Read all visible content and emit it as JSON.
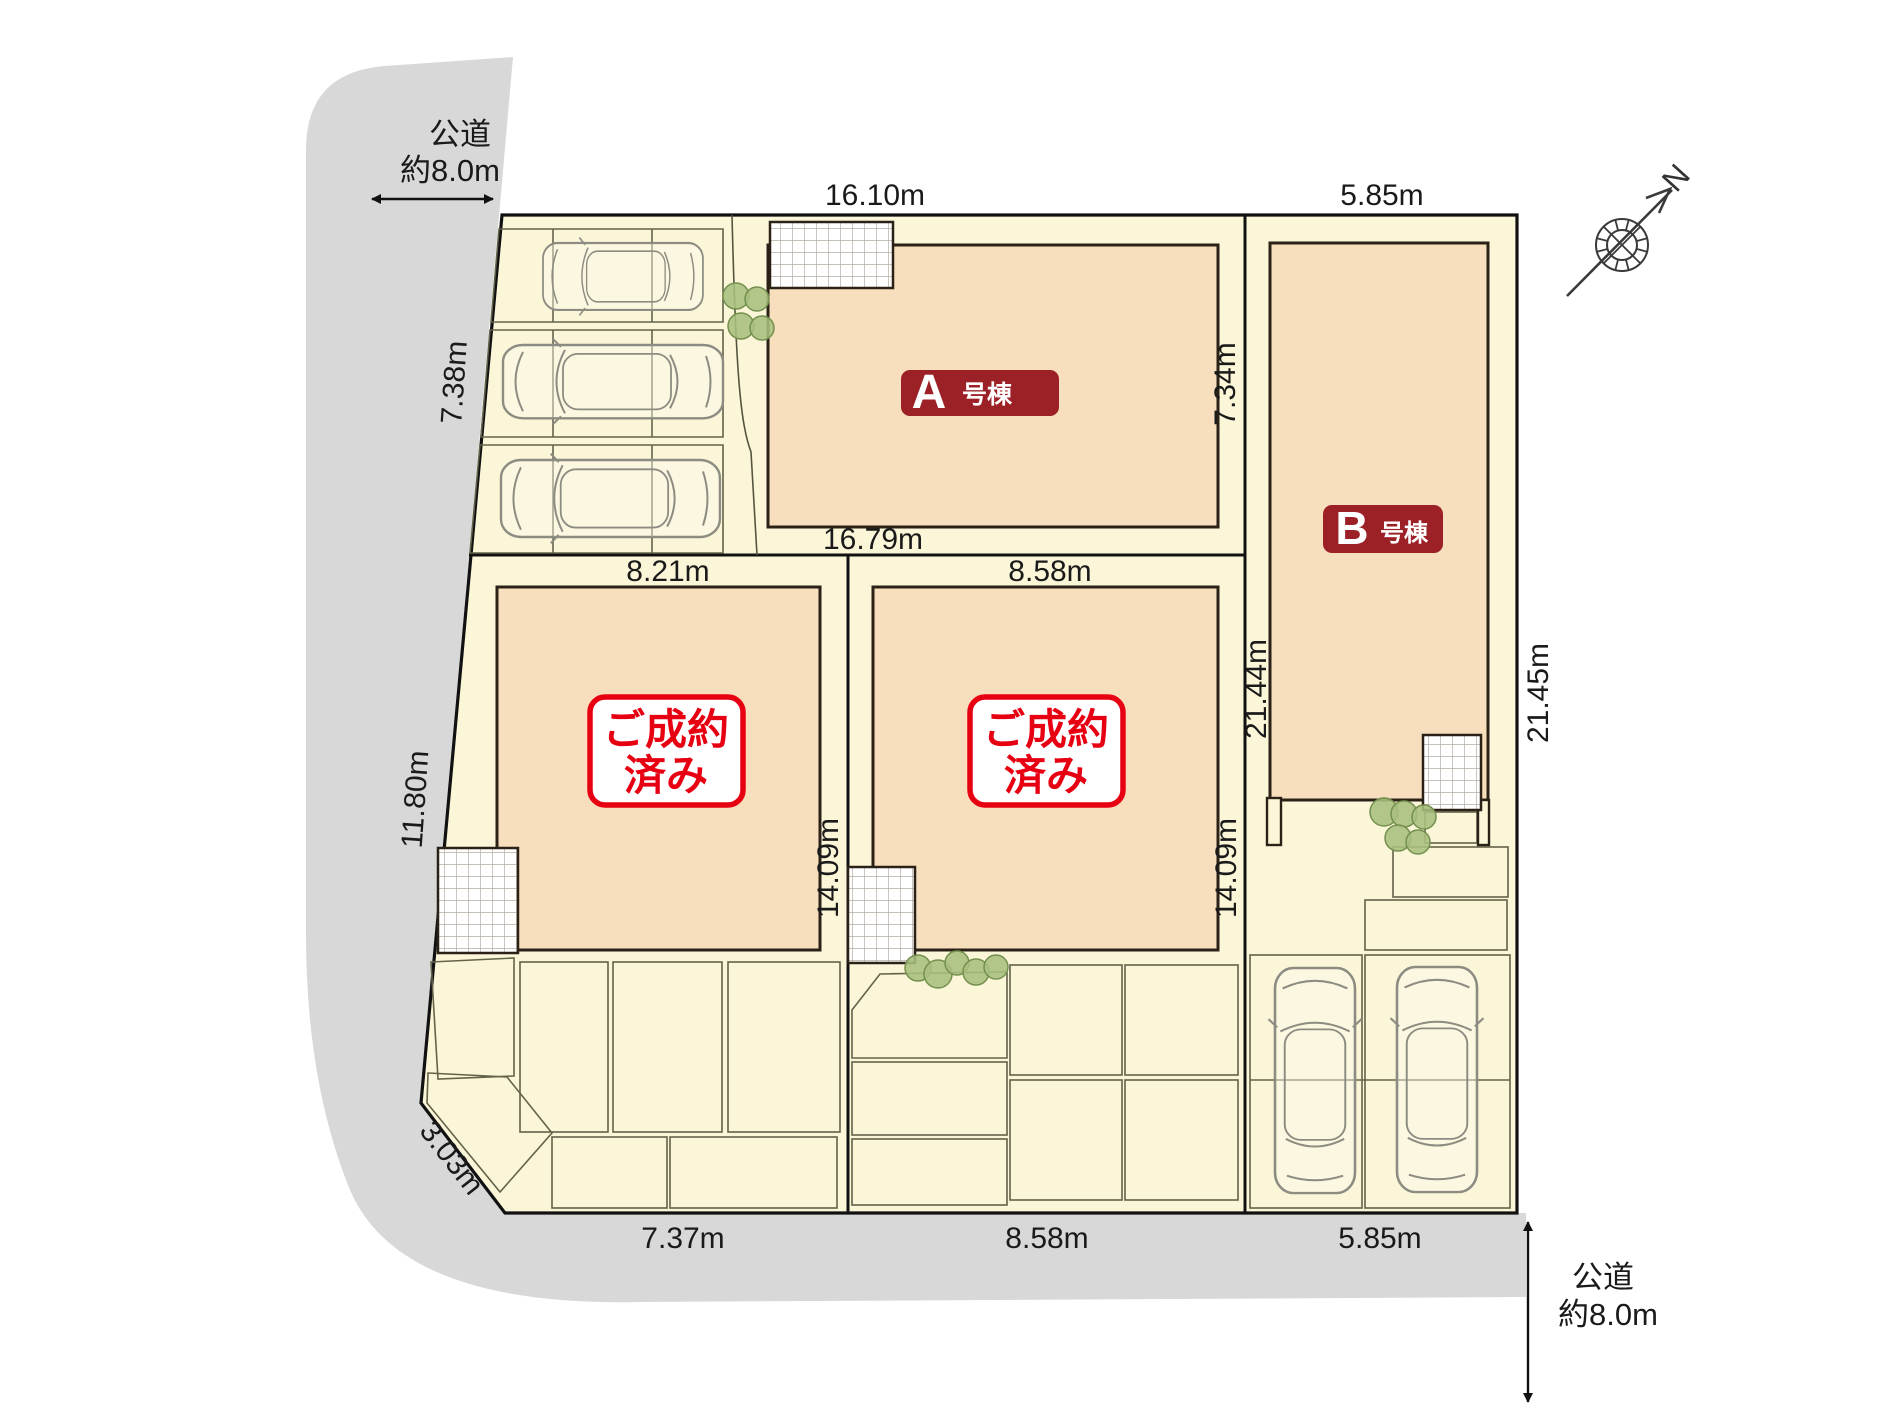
{
  "title": "分譲地 区画図 (site plan)",
  "compass": {
    "label": "N"
  },
  "roads": {
    "top_left": {
      "name_line1": "公道",
      "name_line2": "約8.0m"
    },
    "bottom_right": {
      "name_line1": "公道",
      "name_line2": "約8.0m"
    }
  },
  "units": {
    "a": {
      "label": "A",
      "suffix": "号棟"
    },
    "b": {
      "label": "B",
      "suffix": "号棟"
    },
    "sold_left": {
      "line1": "ご成約",
      "line2": "済み"
    },
    "sold_middle": {
      "line1": "ご成約",
      "line2": "済み"
    }
  },
  "dimensions": {
    "lot_a_top": "16.10m",
    "lot_b_top": "5.85m",
    "left_upper": "7.38m",
    "left_lower": "11.80m",
    "corner_chamfer": "3.03m",
    "bottom_left_lot": "7.37m",
    "bottom_middle_lot": "8.58m",
    "bottom_b_lot": "5.85m",
    "a_bottom": "16.79m",
    "a_right": "7.34m",
    "sold_left_top": "8.21m",
    "sold_middle_top": "8.58m",
    "sold_left_side": "14.09m",
    "sold_middle_side": "14.09m",
    "b_left_side": "21.44m",
    "b_right_side": "21.45m"
  },
  "colors": {
    "road_gray": "#d8d8d9",
    "lot_cream": "#fbf6d8",
    "building_peach": "#f7dfbd",
    "outline_dark": "#2b2117",
    "unit_badge_red": "#9b2127",
    "sold_red": "#e60012",
    "bush_green": "#a9bf7e"
  }
}
